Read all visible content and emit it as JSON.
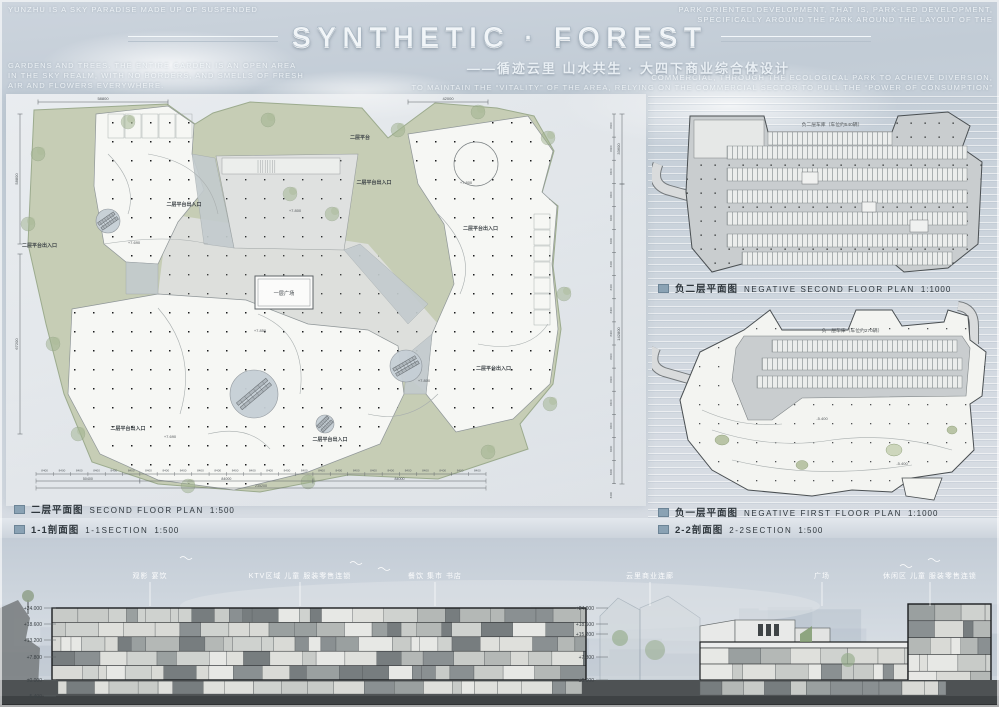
{
  "header": {
    "title": "SYNTHETIC · FOREST",
    "subtitle": "——循迹云里 山水共生 · 大四下商业综合体设计",
    "left_block1": "YUNZHU IS A SKY PARADISE MADE UP OF SUSPENDED",
    "left_block2_lines": [
      "GARDENS AND TREES. THE ENTIRE GARDEN IS AN OPEN AREA",
      "IN THE SKY REALM, WITH NO BORDERS, AND SMELLS OF FRESH",
      "AIR AND FLOWERS EVERYWHERE."
    ],
    "right_block1_lines": [
      "PARK ORIENTED DEVELOPMENT, THAT IS, PARK-LED DEVELOPMENT,",
      "SPECIFICALLY AROUND THE PARK AROUND THE LAYOUT OF THE"
    ],
    "right_block2_lines": [
      "COMMERCIAL, THROUGH THE ECOLOGICAL PARK TO ACHIEVE DIVERSION,",
      "TO MAINTAIN THE “VITALITY” OF THE AREA, RELYING ON THE COMMERCIAL SECTOR TO PULL THE “POWER OF CONSUMPTION”"
    ]
  },
  "plans": {
    "second_floor": {
      "label_cn": "二层平面图",
      "label_en": "SECOND FLOOR PLAN",
      "scale": "1:500",
      "plaza_label": "一层广场",
      "terrace_label": "二层平台",
      "entrance_label": "二层平台出入口",
      "elevations": [
        "+7.690",
        "+7.800",
        "+7.800",
        "+7.850",
        "+7.690",
        "+7.800"
      ],
      "dim_unit": "8400",
      "dim_top_left": "58800",
      "dim_top_right": "42000",
      "dim_left_segments": [
        "58800",
        "67200"
      ],
      "dim_right_totals": [
        "33600",
        "142800"
      ],
      "dim_bottom_groups": [
        "50400",
        "84000",
        "84000"
      ],
      "dim_bottom_total": "235200"
    },
    "neg2": {
      "label_cn": "负二层平面图",
      "label_en": "NEGATIVE SECOND FLOOR PLAN",
      "scale": "1:1000",
      "note": "负二层车库（车位约540辆）"
    },
    "neg1": {
      "label_cn": "负一层平面图",
      "label_en": "NEGATIVE FIRST FLOOR PLAN",
      "scale": "1:1000",
      "note": "负一层车库（车位约270辆）",
      "level_tag": "-5.400"
    }
  },
  "sections": {
    "s11": {
      "label_cn": "1-1剖面图",
      "label_en": "1-1SECTION",
      "scale": "1:500",
      "levels": [
        "+24.000",
        "+18.600",
        "+13.200",
        "+7.800",
        "±0.000",
        "-5.400"
      ],
      "callouts": [
        "观影 宴饮",
        "KTV区域 儿童 服装零售连锁",
        "餐饮 集市 书店"
      ]
    },
    "s22": {
      "label_cn": "2-2剖面图",
      "label_en": "2-2SECTION",
      "scale": "1:500",
      "levels": [
        "+24.000",
        "+18.600",
        "+15.200",
        "+7.800",
        "±0.000"
      ],
      "callouts": [
        "云里商业连廊",
        "广场",
        "休闲区 儿童 服装零售连锁"
      ]
    }
  },
  "colors": {
    "legend_square": "#8aa2b4",
    "site_green": "#c6cdb5",
    "plan_paper": "#f6f7f4",
    "parking_gray": "#c9cdcf",
    "ground_dark": "#4e5254"
  }
}
